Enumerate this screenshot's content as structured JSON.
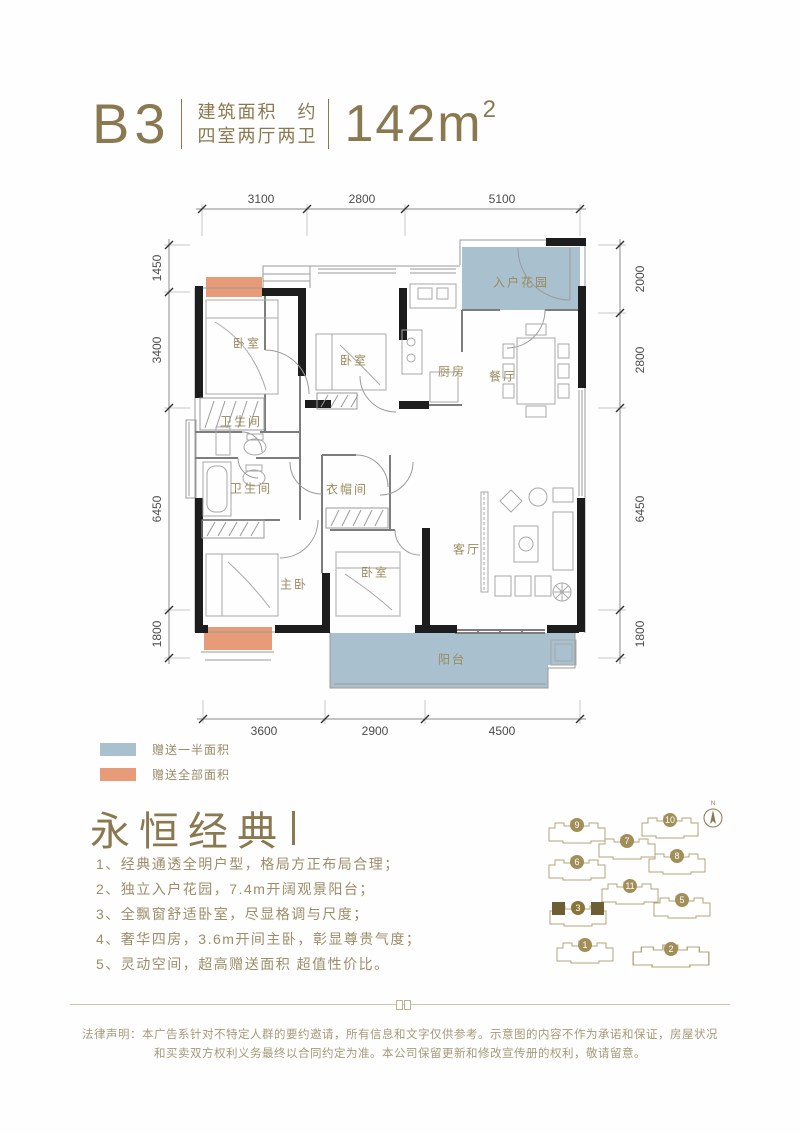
{
  "colors": {
    "gold": "#8a7950",
    "body_text_gold": "#9c8d68",
    "gift_half_blue": "#a9c0cf",
    "gift_full_orange": "#e89b78",
    "wall_black": "#1d1d1d"
  },
  "header": {
    "unit": "B3",
    "spec_line1": "建筑面积　约",
    "spec_line2": "四室两厅两卫",
    "area_value": "142m",
    "area_sup": "2"
  },
  "floorplan": {
    "dims_top": [
      "3100",
      "2800",
      "5100"
    ],
    "dims_left": [
      "1450",
      "3400",
      "6450",
      "1800"
    ],
    "dims_right": [
      "2000",
      "2800",
      "6450",
      "1800"
    ],
    "dims_bottom": [
      "3600",
      "2900",
      "4500"
    ],
    "rooms": [
      {
        "id": "bedroom-1",
        "label": "卧室"
      },
      {
        "id": "bedroom-2",
        "label": "卧室"
      },
      {
        "id": "kitchen",
        "label": "厨房"
      },
      {
        "id": "dining-room",
        "label": "餐厅"
      },
      {
        "id": "entry-garden",
        "label": "入户花园"
      },
      {
        "id": "bathroom-1",
        "label": "卫生间"
      },
      {
        "id": "bathroom-2",
        "label": "卫生间"
      },
      {
        "id": "cloakroom",
        "label": "衣帽间"
      },
      {
        "id": "master-bedroom",
        "label": "主卧"
      },
      {
        "id": "bedroom-3",
        "label": "卧室"
      },
      {
        "id": "living-room",
        "label": "客厅"
      },
      {
        "id": "balcony",
        "label": "阳台"
      }
    ]
  },
  "legend": [
    {
      "label": "赠送一半面积"
    },
    {
      "label": "赠送全部面积"
    }
  ],
  "section": {
    "title": "永恒经典",
    "features": [
      "1、经典通透全明户型，格局方正布局合理；",
      "2、独立入户花园，7.4m开阔观景阳台；",
      "3、全飘窗舒适卧室，尽显格调与尺度；",
      "4、奢华四房，3.6m开间主卧，彰显尊贵气度；",
      "5、灵动空间，超高赠送面积 超值性价比。"
    ]
  },
  "siteplan": {
    "compass_label": "N",
    "highlighted_building": "3",
    "buildings": [
      {
        "no": "9"
      },
      {
        "no": "10"
      },
      {
        "no": "7"
      },
      {
        "no": "6"
      },
      {
        "no": "8"
      },
      {
        "no": "11"
      },
      {
        "no": "3"
      },
      {
        "no": "5"
      },
      {
        "no": "1"
      },
      {
        "no": "2"
      }
    ]
  },
  "disclaimer": "法律声明：本广告系针对不特定人群的要约邀请，所有信息和文字仅供参考。示意图的内容不作为承诺和保证，房屋状况和买卖双方权利义务最终以合同约定为准。本公司保留更新和修改宣传册的权利，敬请留意。"
}
